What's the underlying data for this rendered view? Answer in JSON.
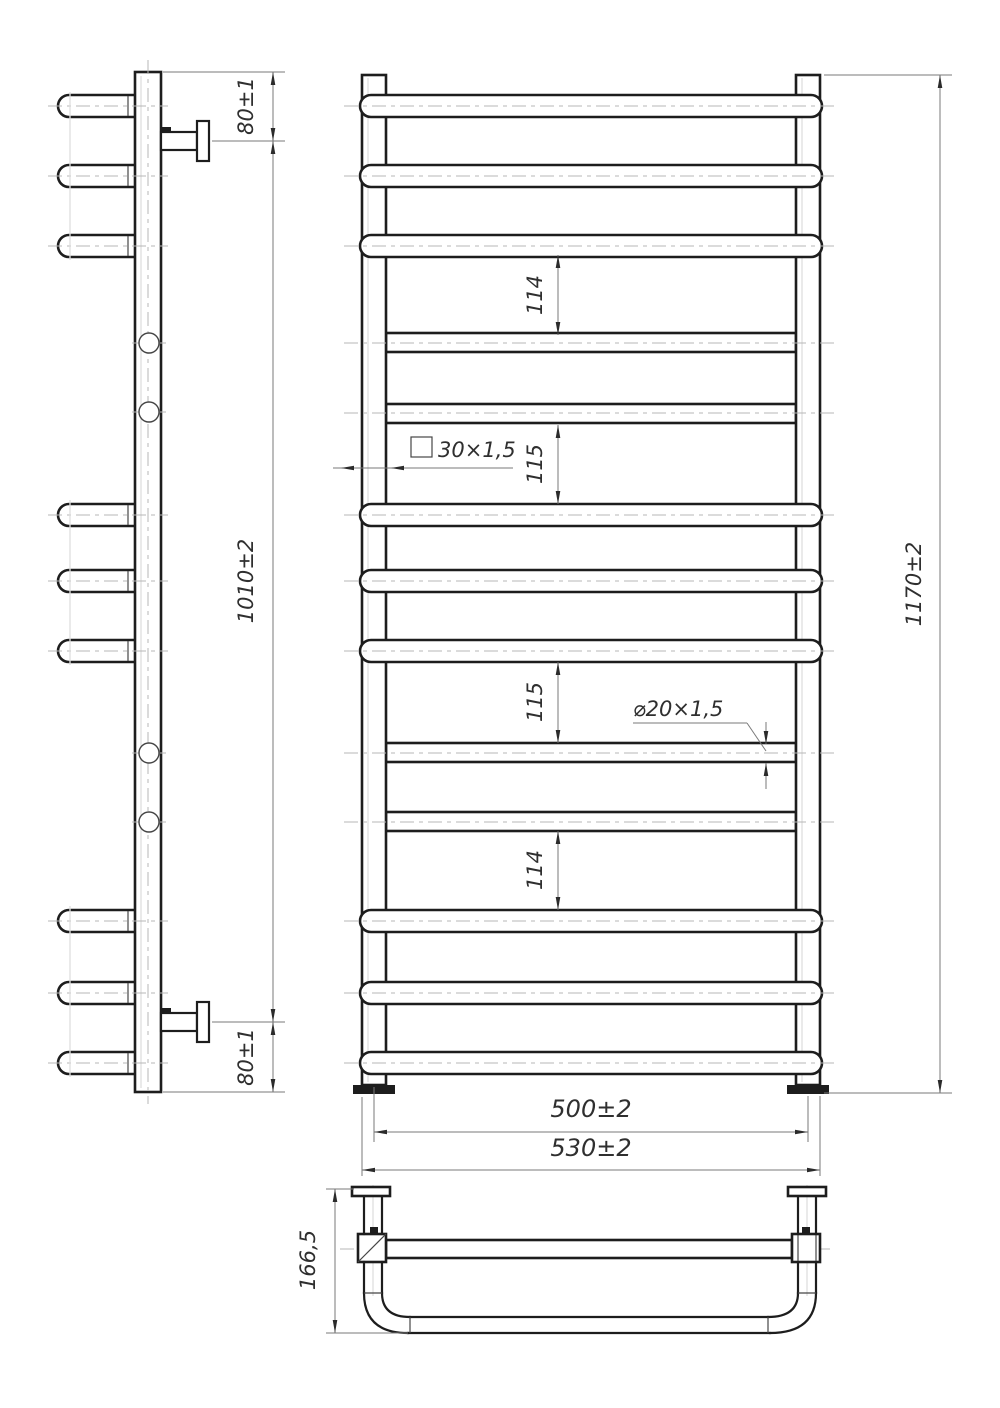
{
  "drawing": {
    "title": "Ladder towel rail — dimensioned technical drawing, three views",
    "background": "#ffffff",
    "line_color": "#1d1d1d",
    "dimension_line_color": "#7a7a7a",
    "centerline_color": "#b7b7b7",
    "views": {
      "side_view": {
        "label": "side view",
        "wall_brackets": 2,
        "protruding_rungs": 9,
        "straight_rung_ends": 4
      },
      "front_view": {
        "label": "front view",
        "posts": 2,
        "rungs_total": 13,
        "protruding_rungs": 9,
        "straight_rungs": 4
      },
      "top_view": {
        "label": "top view",
        "wall_brackets": 2,
        "shows": "square posts, straight tube, U-shaped front rung"
      }
    },
    "dims": {
      "top_offset": "80±1",
      "rail_span": "1010±2",
      "bottom_offset": "80±1",
      "height": "1170±2",
      "gap1": "114",
      "gap2": "115",
      "gap3": "115",
      "gap4": "114",
      "profile": "30×1,5",
      "tube": "⌀20×1,5",
      "axis_width": "500±2",
      "width": "530±2",
      "depth": "166,5"
    }
  }
}
